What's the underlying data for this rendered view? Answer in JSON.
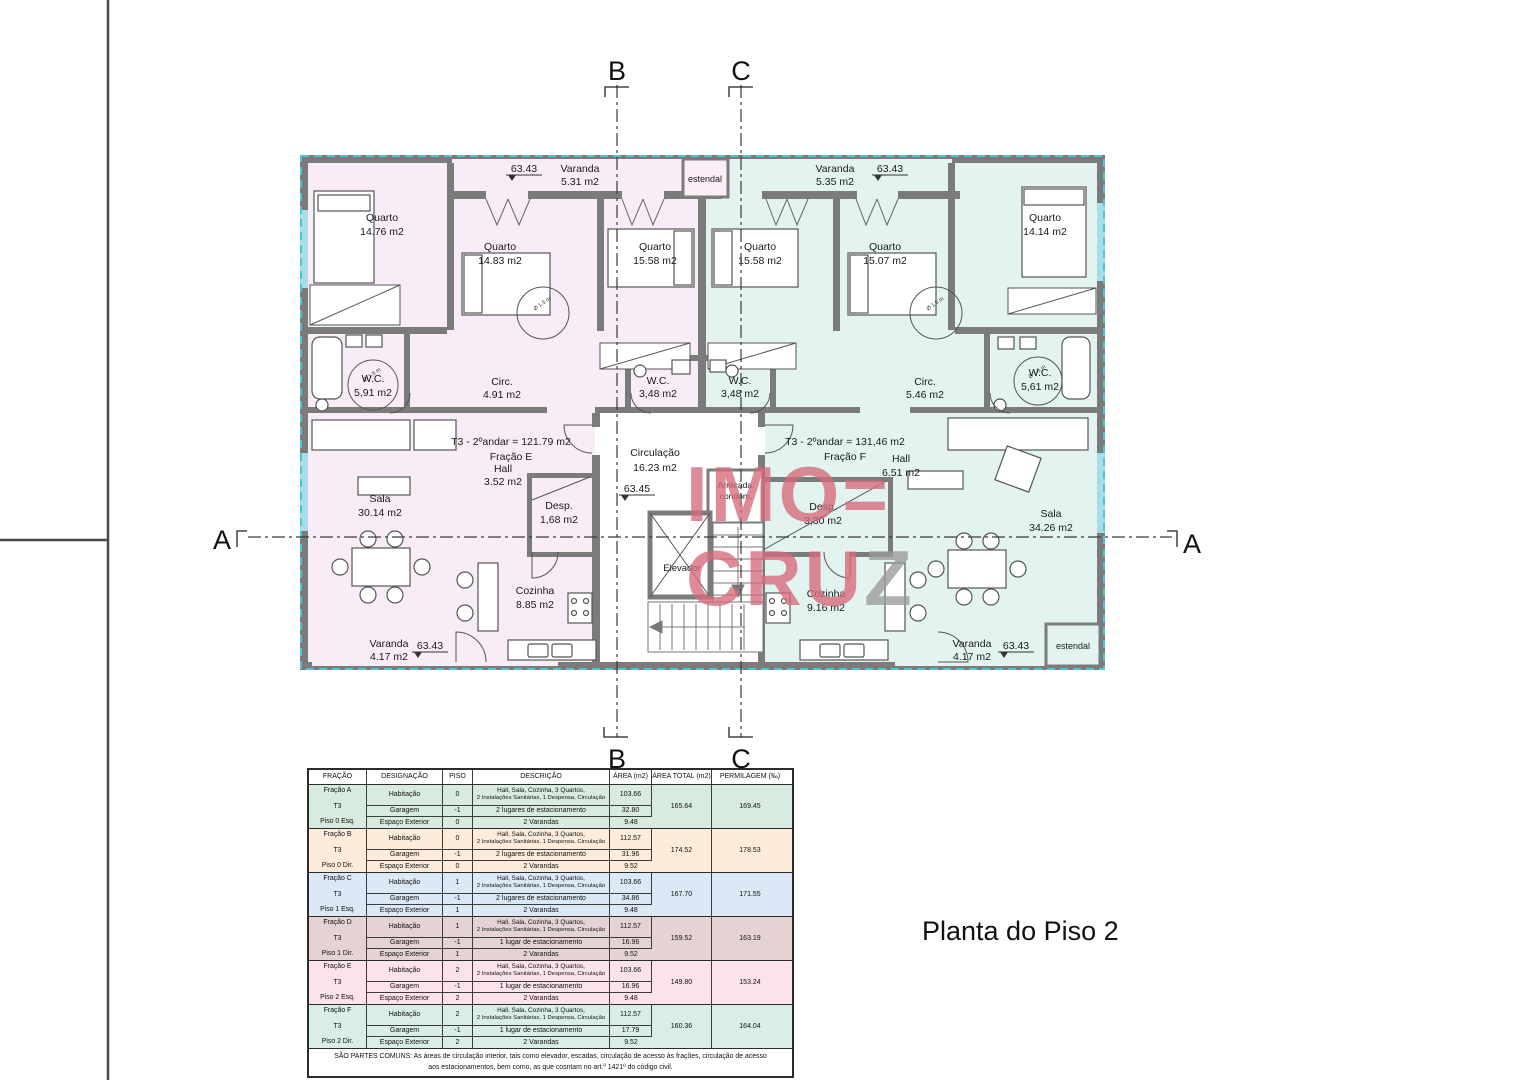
{
  "sheet": {
    "title": "Planta do Piso 2"
  },
  "sections": {
    "a": "A",
    "b": "B",
    "c": "C"
  },
  "watermark": {
    "line1": "IMO=",
    "line2a": "CRU",
    "line2b": "Z",
    "red": "#d66a7a",
    "gray": "#9a9a9a"
  },
  "colors": {
    "apartment_e_fill": "#f8ecf6",
    "apartment_f_fill": "#e2f3f0",
    "wall_gray": "#7b7b7b",
    "boundary_cyan": "#4cc5d6"
  },
  "plan": {
    "circle_label": "Ø 1.5 m",
    "levels": {
      "varanda_top_left": "63.43",
      "varanda_top_right": "63.43",
      "circulacao": "63.45",
      "varanda_bottom_left": "63.43",
      "varanda_bottom_right": "63.43"
    },
    "apartments": {
      "e": {
        "title": "T3 - 2ºandar = 121.79 m2",
        "fraction": "Fração E"
      },
      "f": {
        "title": "T3 - 2ºandar  = 131,46 m2",
        "fraction": "Fração F"
      }
    },
    "rooms": {
      "varanda_top_left": {
        "name": "Varanda",
        "area": "5.31 m2"
      },
      "estendal_top": {
        "name": "estendal"
      },
      "varanda_top_right": {
        "name": "Varanda",
        "area": "5.35 m2"
      },
      "quarto_e1": {
        "name": "Quarto",
        "area": "14.76 m2"
      },
      "quarto_e2": {
        "name": "Quarto",
        "area": "14.83 m2"
      },
      "quarto_e3": {
        "name": "Quarto",
        "area": "15.58 m2"
      },
      "quarto_f1": {
        "name": "Quarto",
        "area": "15.58 m2"
      },
      "quarto_f2": {
        "name": "Quarto",
        "area": "15.07 m2"
      },
      "quarto_f3": {
        "name": "Quarto",
        "area": "14.14 m2"
      },
      "wc_e1": {
        "name": "W.C.",
        "area": "5,91 m2"
      },
      "circ_e": {
        "name": "Circ.",
        "area": "4.91 m2"
      },
      "wc_e2": {
        "name": "W.C.",
        "area": "3,48 m2"
      },
      "wc_f1": {
        "name": "W.C.",
        "area": "3,48 m2"
      },
      "circ_f": {
        "name": "Circ.",
        "area": "5.46 m2"
      },
      "wc_f2": {
        "name": "W.C.",
        "area": "5,61 m2"
      },
      "sala_e": {
        "name": "Sala",
        "area": "30.14 m2"
      },
      "hall_e": {
        "name": "Hall",
        "area": "3.52 m2"
      },
      "desp_e": {
        "name": "Desp.",
        "area": "1,68 m2"
      },
      "cozinha_e": {
        "name": "Cozinha",
        "area": "8.85 m2"
      },
      "varanda_bottom_left": {
        "name": "Varanda",
        "area": "4.17 m2"
      },
      "circulacao": {
        "name": "Circulação",
        "area": "16.23 m2"
      },
      "elevador": {
        "name": "Elevador"
      },
      "arrecada": {
        "line1": "Arrecada.",
        "line2": "condom."
      },
      "hall_f": {
        "name": "Hall",
        "area": "6.51 m2"
      },
      "desp_f": {
        "name": "Desp.",
        "area": "3,30 m2"
      },
      "cozinha_f": {
        "name": "Cozinha",
        "area": "9.16 m2"
      },
      "sala_f": {
        "name": "Sala",
        "area": "34.26 m2"
      },
      "varanda_bottom_right": {
        "name": "Varanda",
        "area": "4.17 m2"
      },
      "estendal_bottom": {
        "name": "estendal"
      }
    }
  },
  "table": {
    "headers": [
      "FRAÇÃO",
      "DESIGNAÇÃO",
      "PISO",
      "DESCRIÇÃO",
      "ÁREA (m2)",
      "ÁREA TOTAL (m2)",
      "PERMILAGEM (‰)"
    ],
    "groups": [
      {
        "color": "#d8ebe1",
        "fracao": "Fração A",
        "tipo": "T3",
        "piso_label": "Piso 0 Esq.",
        "rows": [
          {
            "designacao": "Habitação",
            "piso": "0",
            "desc_l1": "Hall, Sala, Cozinha, 3 Quartos,",
            "desc_l2": "2 Instalações Sanitárias, 1 Despensa, Circulação",
            "area": "103.66"
          },
          {
            "designacao": "Garagem",
            "piso": "-1",
            "desc": "2 lugares de estacionamento",
            "area": "32.80"
          },
          {
            "designacao": "Espaço Exterior",
            "piso": "0",
            "desc": "2 Varandas",
            "area": "9.48"
          }
        ],
        "area_total": "165.64",
        "permilagem": "169.45"
      },
      {
        "color": "#fcecd9",
        "fracao": "Fração B",
        "tipo": "T3",
        "piso_label": "Piso 0 Dir.",
        "rows": [
          {
            "designacao": "Habitação",
            "piso": "0",
            "desc_l1": "Hall, Sala, Cozinha, 3 Quartos,",
            "desc_l2": "2 Instalações Sanitárias, 1 Despensa, Circulação",
            "area": "112.57"
          },
          {
            "designacao": "Garagem",
            "piso": "-1",
            "desc": "2 lugares de estacionamento",
            "area": "31.96"
          },
          {
            "designacao": "Espaço Exterior",
            "piso": "0",
            "desc": "2 Varandas",
            "area": "9.52"
          }
        ],
        "area_total": "174.52",
        "permilagem": "178.53"
      },
      {
        "color": "#dbe8f6",
        "fracao": "Fração C",
        "tipo": "T3",
        "piso_label": "Piso 1 Esq.",
        "rows": [
          {
            "designacao": "Habitação",
            "piso": "1",
            "desc_l1": "Hall, Sala, Cozinha, 3 Quartos,",
            "desc_l2": "2 Instalações Sanitárias, 1 Despensa, Circulação",
            "area": "103.66"
          },
          {
            "designacao": "Garagem",
            "piso": "-1",
            "desc": "2 lugares de estacionamento",
            "area": "34.86"
          },
          {
            "designacao": "Espaço Exterior",
            "piso": "1",
            "desc": "2 Varandas",
            "area": "9.48"
          }
        ],
        "area_total": "167.70",
        "permilagem": "171.55"
      },
      {
        "color": "#e5d3d3",
        "fracao": "Fração D",
        "tipo": "T3",
        "piso_label": "Piso 1 Dir.",
        "rows": [
          {
            "designacao": "Habitação",
            "piso": "1",
            "desc_l1": "Hall, Sala, Cozinha, 3 Quartos,",
            "desc_l2": "2 Instalações Sanitárias, 1 Despensa, Circulação",
            "area": "112.57"
          },
          {
            "designacao": "Garagem",
            "piso": "-1",
            "desc": "1 lugar de estacionamento",
            "area": "16.96"
          },
          {
            "designacao": "Espaço Exterior",
            "piso": "1",
            "desc": "2 Varandas",
            "area": "9.52"
          }
        ],
        "area_total": "159.52",
        "permilagem": "163.19"
      },
      {
        "color": "#fbe2ed",
        "fracao": "Fração E",
        "tipo": "T3",
        "piso_label": "Piso 2 Esq.",
        "rows": [
          {
            "designacao": "Habitação",
            "piso": "2",
            "desc_l1": "Hall, Sala, Cozinha, 3 Quartos,",
            "desc_l2": "2 Instalações Sanitárias, 1 Despensa, Circulação",
            "area": "103.66"
          },
          {
            "designacao": "Garagem",
            "piso": "-1",
            "desc": "1 lugar de estacionamento",
            "area": "16.96"
          },
          {
            "designacao": "Espaço Exterior",
            "piso": "2",
            "desc": "2 Varandas",
            "area": "9.48"
          }
        ],
        "area_total": "149.80",
        "permilagem": "153.24"
      },
      {
        "color": "#d9eee8",
        "fracao": "Fração F",
        "tipo": "T3",
        "piso_label": "Piso 2 Dir.",
        "rows": [
          {
            "designacao": "Habitação",
            "piso": "2",
            "desc_l1": "Hall, Sala, Cozinha, 3 Quartos,",
            "desc_l2": "2 Instalações Sanitárias, 1 Despensa, Circulação",
            "area": "112.57"
          },
          {
            "designacao": "Garagem",
            "piso": "-1",
            "desc": "1 lugar de estacionamento",
            "area": "17.79"
          },
          {
            "designacao": "Espaço Exterior",
            "piso": "2",
            "desc": "2 Varandas",
            "area": "9.52"
          }
        ],
        "area_total": "160.36",
        "permilagem": "164.04"
      }
    ],
    "footer_l1": "SÃO PARTES COMUNS: As áreas de circulação interior, tais como elevador, escadas, circulação de acesso às frações, circulação de acesso",
    "footer_l2": "aos estacionamentos, bem como, as que cosntam no art.º 1421º do código civil."
  }
}
